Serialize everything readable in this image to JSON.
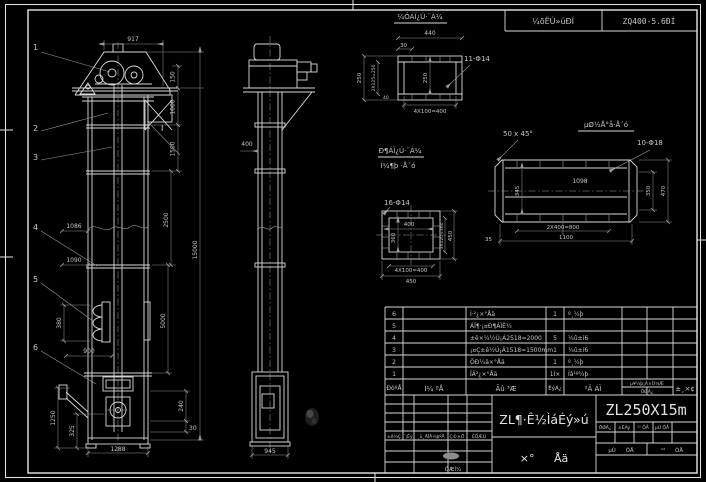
{
  "header_strip": {
    "label": "¼õËÙ»úÐÍ",
    "value": "ZQ400-5.6ÐÍ"
  },
  "front_view": {
    "balloons": [
      "1",
      "2",
      "3",
      "4",
      "5",
      "6"
    ],
    "section_mark": "I",
    "dim_width_top": "917",
    "dim_150": "150",
    "dim_1000": "1000",
    "dim_1500": "1500",
    "dim_2500": "2500",
    "dim_5000": "5000",
    "dim_total_height": "15000",
    "dim_1086": "1086",
    "dim_1090": "1090",
    "dim_380": "380",
    "dim_900": "900",
    "dim_1250": "1250",
    "dim_325": "325",
    "dim_240": "240",
    "dim_30": "30",
    "dim_base_width": "1288"
  },
  "side_view": {
    "dim_depth": "400",
    "dim_base_width": "945"
  },
  "detail_inlet": {
    "title": "¼ÓÁÏ¿Ú·¨À¼",
    "holes_label": "11-Φ14",
    "dim_width": "440",
    "dim_30": "30",
    "dim_height": "250",
    "dim_pitch_v": "2X125=250",
    "dim_inner": "250",
    "dim_40": "40",
    "dim_pitch_h": "4X100=400"
  },
  "detail_base_plate": {
    "title": "µØ½Å°å·Å´ó",
    "chamfer_label": "50 x 45°",
    "holes_label": "10-Φ18",
    "dim_inner_width": "1098",
    "dim_inner_height": "345",
    "dim_350": "350",
    "dim_470": "470",
    "dim_pitch": "2X400=800",
    "dim_width": "1100",
    "dim_35": "35"
  },
  "detail_outlet": {
    "title_line1": "Ð¶ÁÏ¿Ú·¨À¼",
    "title_line2": "Í¼¶þ ·Å´ó",
    "holes_label": "16-Φ14",
    "dim_inner_width": "400",
    "dim_inner_height": "360",
    "dim_pitch_v": "3X120=360",
    "dim_height": "450",
    "dim_pitch_h": "4X100=400",
    "dim_width": "450"
  },
  "bom": {
    "rows": [
      {
        "no": "6",
        "dwg": "",
        "name": "Í·²¿×°Åä",
        "qty": "1",
        "material": "º¸¼þ"
      },
      {
        "no": "5",
        "dwg": "",
        "name": "ÁÏ¶·¡¤Ð¶ÁÏÊ½",
        "qty": "",
        "material": ""
      },
      {
        "no": "4",
        "dwg": "",
        "name": "±ê×¼½Ú¡Á2518=2000",
        "qty": "5",
        "material": "¼û±í6"
      },
      {
        "no": "3",
        "dwg": "",
        "name": "¡¤Ç±ê½Ú¡Á1518=1500mm",
        "qty": "1",
        "material": "¼û±í6"
      },
      {
        "no": "2",
        "dwg": "",
        "name": "ÖÐ¼ä×°Åä",
        "qty": "1",
        "material": "º¸¼þ"
      },
      {
        "no": "1",
        "dwg": "",
        "name": "ÏÂ²¿×°Åä",
        "qty": "1Ì×",
        "material": "Íâ¹º¼þ"
      }
    ],
    "headers": {
      "no": "ÐòºÅ",
      "dwg": "Í¼ ºÅ",
      "name": "Ãû ³Æ",
      "qty": "ÊýÁ¿",
      "material": "²Ä ÁÏ",
      "weight_top": "µ¥¼þ¡Á×Ü¼Æ",
      "weight_bottom": "ÖØÁ¿",
      "remark": "±¸×¢"
    }
  },
  "title_block": {
    "product_title": "ZL¶·Ê½ÌáÉý»ú",
    "drawing_no": "ZL250X15m",
    "assembly": "×° Åä",
    "rev_headers": {
      "mark": "±ê¼Ç",
      "count": "´¦Êý",
      "doc": "¸ü¸ÄÎÄ¼þºÅ",
      "sign": "Ç©×Ö",
      "date": "ÈÕÆÚ"
    },
    "sig_label": "ÖÆÍ¼",
    "info": {
      "c1": "ÖØÁ¿",
      "c2": "±ÈÀý",
      "c3": "¹² ÕÅ",
      "c4": "µÚ ÕÅ",
      "left": "µÚ ÕÅ",
      "right": "¹² ÕÅ"
    }
  }
}
